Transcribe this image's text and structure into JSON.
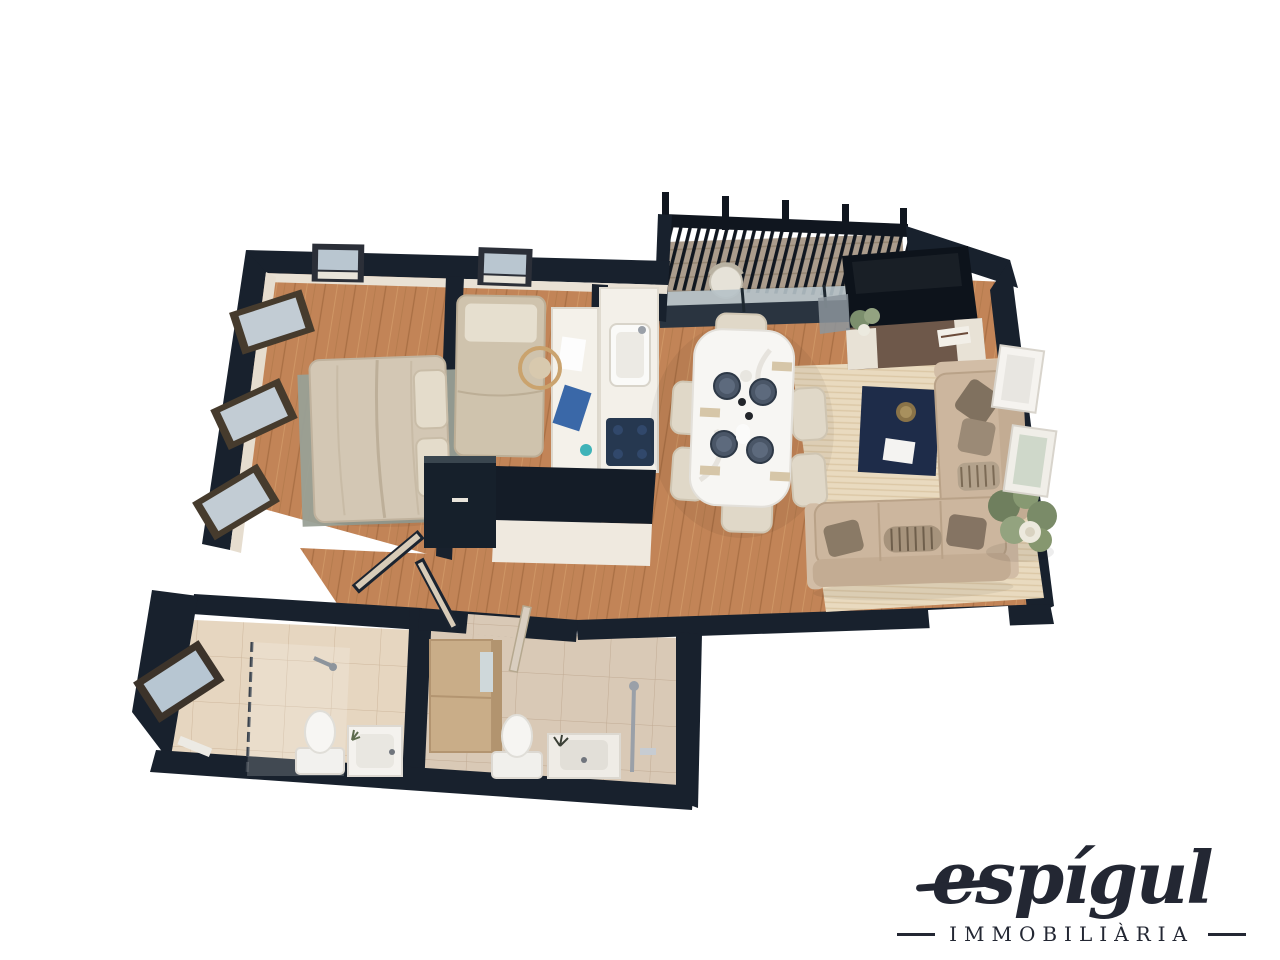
{
  "logo": {
    "brand": "espígul",
    "tagline": "IMMOBILIÀRIA"
  },
  "floor_plan": {
    "view": "top-down-3d-render",
    "rooms": [
      {
        "id": "master-bedroom",
        "furniture": [
          "double-bed",
          "pillows",
          "area-rug"
        ],
        "windows": 4
      },
      {
        "id": "second-bedroom",
        "furniture": [
          "single-bed",
          "desk",
          "desk-chair",
          "wardrobe"
        ],
        "windows": 1
      },
      {
        "id": "kitchen",
        "furniture": [
          "counter-with-sink",
          "cooktop",
          "island-counter"
        ]
      },
      {
        "id": "living-dining-room",
        "furniture": [
          "dining-table",
          "six-chairs",
          "table-settings",
          "tv",
          "tv-stand",
          "coffee-table",
          "area-rug",
          "sofa",
          "chaise-sofa",
          "corner-plant"
        ],
        "windows": 2
      },
      {
        "id": "balcony",
        "furniture": [
          "slatted-railing",
          "chair",
          "sliding-glass-door"
        ]
      },
      {
        "id": "bathroom-1",
        "furniture": [
          "glass-shower",
          "toilet",
          "vanity-sink"
        ],
        "windows": 1
      },
      {
        "id": "bathroom-2",
        "furniture": [
          "storage-cabinet",
          "toilet",
          "vanity-sink",
          "shower-column"
        ]
      },
      {
        "id": "hallway",
        "furniture": [
          "open-doors"
        ]
      }
    ],
    "colors": {
      "wall": "#18212d",
      "wall_face": "#e9e1d4",
      "wood_floor": "#c28457",
      "tile_floor": "#e6d6c0",
      "living_rug": "#e9dabf",
      "bedroom_rug": "#99a096",
      "sofa": "#ccb69e",
      "accent_navy": "#1e2c49",
      "glass": "#b9c6d0",
      "logo_text": "#232733",
      "background": "#ffffff"
    }
  }
}
